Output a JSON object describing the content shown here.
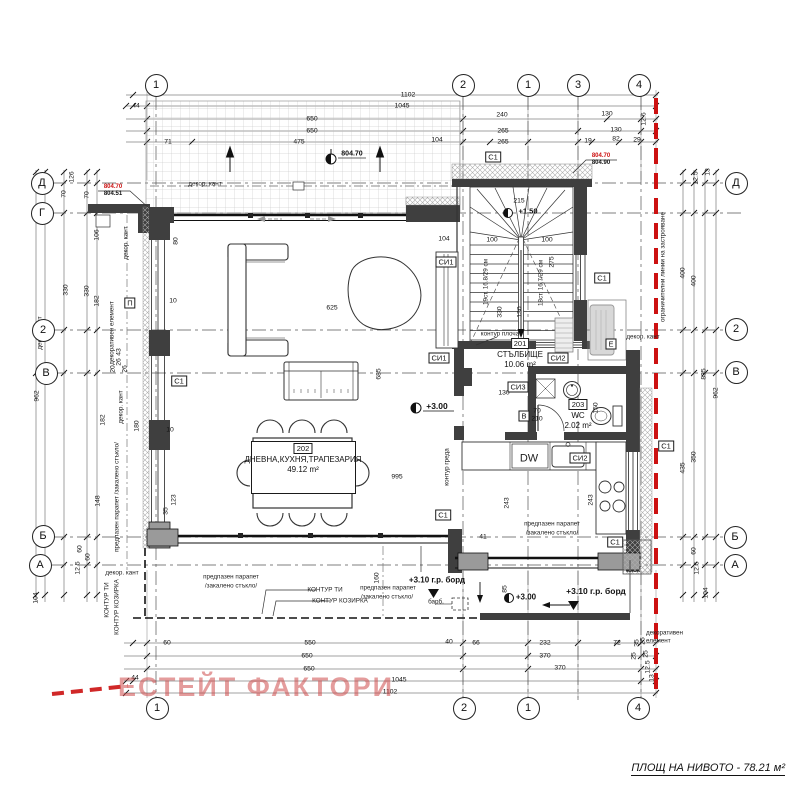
{
  "meta": {
    "watermark": "ЕСТЕЙТ ФАКТОРИ",
    "area_note": "ПЛОЩ НА НИВОТО - 78.21 м²"
  },
  "colors": {
    "regulation_line_red": "#cc1111",
    "wall_dark": "#3f3f3f",
    "pier_gray": "#9a9a9a",
    "watermark_red": "rgba(205,75,75,0.55)"
  },
  "grid_bubbles": [
    {
      "label": "1",
      "x": 156,
      "y": 85
    },
    {
      "label": "2",
      "x": 463,
      "y": 85
    },
    {
      "label": "1",
      "x": 528,
      "y": 85,
      "diamond": true
    },
    {
      "label": "3",
      "x": 578,
      "y": 85
    },
    {
      "label": "4",
      "x": 639,
      "y": 85
    },
    {
      "label": "1",
      "x": 157,
      "y": 708
    },
    {
      "label": "2",
      "x": 464,
      "y": 708
    },
    {
      "label": "1",
      "x": 528,
      "y": 708,
      "diamond": true
    },
    {
      "label": "4",
      "x": 638,
      "y": 708
    },
    {
      "label": "Д",
      "x": 42,
      "y": 183
    },
    {
      "label": "Г",
      "x": 42,
      "y": 213
    },
    {
      "label": "2",
      "x": 43,
      "y": 330,
      "diamond": true
    },
    {
      "label": "В",
      "x": 46,
      "y": 373
    },
    {
      "label": "Б",
      "x": 43,
      "y": 536
    },
    {
      "label": "А",
      "x": 40,
      "y": 565
    },
    {
      "label": "Д",
      "x": 736,
      "y": 183
    },
    {
      "label": "2",
      "x": 736,
      "y": 329,
      "diamond": true
    },
    {
      "label": "В",
      "x": 736,
      "y": 372
    },
    {
      "label": "Б",
      "x": 735,
      "y": 537
    },
    {
      "label": "А",
      "x": 735,
      "y": 565
    }
  ],
  "rooms": [
    {
      "number": "202",
      "name": "ДНЕВНА,КУХНЯ,ТРАПЕЗАРИЯ",
      "area": "49.12 m²",
      "cx": 303,
      "top": 443,
      "boxed": true,
      "bx": 251,
      "by": 441,
      "bw": 103,
      "bh": 51
    },
    {
      "number": "201",
      "name": "СТЪЛБИЩЕ",
      "area": "10.06 m²",
      "cx": 520,
      "top": 338
    },
    {
      "number": "203",
      "name": "WC",
      "area": "2.02 m²",
      "cx": 578,
      "top": 399
    }
  ],
  "tags": [
    {
      "t": "C1",
      "x": 493,
      "y": 157
    },
    {
      "t": "C1",
      "x": 602,
      "y": 278
    },
    {
      "t": "C1",
      "x": 179,
      "y": 381
    },
    {
      "t": "C1",
      "x": 443,
      "y": 515
    },
    {
      "t": "C1",
      "x": 615,
      "y": 542
    },
    {
      "t": "C1",
      "x": 666,
      "y": 446
    },
    {
      "t": "СИ1",
      "x": 446,
      "y": 262
    },
    {
      "t": "СИ1",
      "x": 439,
      "y": 358
    },
    {
      "t": "СИ2",
      "x": 558,
      "y": 358
    },
    {
      "t": "СИ2",
      "x": 580,
      "y": 458
    },
    {
      "t": "СИ3",
      "x": 518,
      "y": 387
    },
    {
      "t": "П",
      "x": 130,
      "y": 303
    },
    {
      "t": "B",
      "x": 524,
      "y": 416
    },
    {
      "t": "Е",
      "x": 611,
      "y": 344
    }
  ],
  "levels": [
    {
      "t": "804.70",
      "x": 113,
      "y": 187,
      "red": true,
      "fs": 6
    },
    {
      "t": "804.51",
      "x": 113,
      "y": 194,
      "fs": 6
    },
    {
      "t": "804.70",
      "x": 601,
      "y": 156,
      "red": true,
      "fs": 6
    },
    {
      "t": "804.90",
      "x": 601,
      "y": 163,
      "fs": 6
    },
    {
      "t": "804.70",
      "x": 352,
      "y": 154,
      "fs": 7
    },
    {
      "t": "+1.50",
      "x": 528,
      "y": 211,
      "fs": 7.5
    },
    {
      "t": "+3.00",
      "x": 437,
      "y": 406,
      "fs": 8.5
    },
    {
      "t": "+3.00",
      "x": 526,
      "y": 597,
      "fs": 8
    },
    {
      "t": "+3.10 г.р. борд",
      "x": 437,
      "y": 580,
      "fs": 8
    },
    {
      "t": "+3.10 г.р. борд",
      "x": 596,
      "y": 591,
      "fs": 8.5
    }
  ],
  "dims": [
    {
      "t": "1102",
      "x": 408,
      "y": 95
    },
    {
      "t": "44",
      "x": 136,
      "y": 106
    },
    {
      "t": "1045",
      "x": 402,
      "y": 106
    },
    {
      "t": "650",
      "x": 312,
      "y": 119
    },
    {
      "t": "240",
      "x": 502,
      "y": 115
    },
    {
      "t": "130",
      "x": 607,
      "y": 114
    },
    {
      "t": "12.6",
      "x": 644,
      "y": 119,
      "r": 1
    },
    {
      "t": "650",
      "x": 312,
      "y": 131
    },
    {
      "t": "265",
      "x": 503,
      "y": 131
    },
    {
      "t": "130",
      "x": 616,
      "y": 130
    },
    {
      "t": "71",
      "x": 168,
      "y": 142
    },
    {
      "t": "475",
      "x": 299,
      "y": 142
    },
    {
      "t": "104",
      "x": 437,
      "y": 140
    },
    {
      "t": "265",
      "x": 503,
      "y": 142
    },
    {
      "t": "19",
      "x": 588,
      "y": 141
    },
    {
      "t": "82",
      "x": 616,
      "y": 139
    },
    {
      "t": "29",
      "x": 637,
      "y": 140
    },
    {
      "t": "60",
      "x": 167,
      "y": 643
    },
    {
      "t": "550",
      "x": 310,
      "y": 643
    },
    {
      "t": "40",
      "x": 449,
      "y": 642
    },
    {
      "t": "66",
      "x": 476,
      "y": 643
    },
    {
      "t": "232",
      "x": 545,
      "y": 643
    },
    {
      "t": "72",
      "x": 617,
      "y": 643
    },
    {
      "t": "25",
      "x": 643,
      "y": 641,
      "r": 1
    },
    {
      "t": "650",
      "x": 307,
      "y": 656
    },
    {
      "t": "370",
      "x": 545,
      "y": 656
    },
    {
      "t": "25",
      "x": 646,
      "y": 654,
      "r": 1
    },
    {
      "t": "650",
      "x": 309,
      "y": 669
    },
    {
      "t": "370",
      "x": 560,
      "y": 668
    },
    {
      "t": "12.5",
      "x": 648,
      "y": 667,
      "r": 1
    },
    {
      "t": "1045",
      "x": 399,
      "y": 680
    },
    {
      "t": "13",
      "x": 652,
      "y": 678,
      "r": 1
    },
    {
      "t": "1102",
      "x": 390,
      "y": 692
    },
    {
      "t": "44",
      "x": 135,
      "y": 678
    },
    {
      "t": "962",
      "x": 37,
      "y": 396,
      "r": 1
    },
    {
      "t": "835",
      "x": 45,
      "y": 374,
      "r": 1
    },
    {
      "t": "126",
      "x": 72,
      "y": 177,
      "r": 1
    },
    {
      "t": "70",
      "x": 64,
      "y": 194,
      "r": 1
    },
    {
      "t": "70",
      "x": 87,
      "y": 195,
      "r": 1
    },
    {
      "t": "106",
      "x": 97,
      "y": 235,
      "r": 1
    },
    {
      "t": "330",
      "x": 66,
      "y": 290,
      "r": 1
    },
    {
      "t": "330",
      "x": 87,
      "y": 291,
      "r": 1
    },
    {
      "t": "182",
      "x": 97,
      "y": 301,
      "r": 1
    },
    {
      "t": "148",
      "x": 98,
      "y": 501,
      "r": 1
    },
    {
      "t": "60",
      "x": 80,
      "y": 549,
      "r": 1
    },
    {
      "t": "60",
      "x": 88,
      "y": 557,
      "r": 1
    },
    {
      "t": "12.5",
      "x": 78,
      "y": 568,
      "r": 1
    },
    {
      "t": "104",
      "x": 36,
      "y": 598,
      "r": 1
    },
    {
      "t": "12.5",
      "x": 696,
      "y": 178,
      "r": 1
    },
    {
      "t": "13",
      "x": 708,
      "y": 172,
      "r": 1
    },
    {
      "t": "400",
      "x": 683,
      "y": 273,
      "r": 1
    },
    {
      "t": "400",
      "x": 694,
      "y": 281,
      "r": 1
    },
    {
      "t": "835",
      "x": 704,
      "y": 374,
      "r": 1
    },
    {
      "t": "962",
      "x": 716,
      "y": 393,
      "r": 1
    },
    {
      "t": "350",
      "x": 694,
      "y": 457,
      "r": 1
    },
    {
      "t": "435",
      "x": 683,
      "y": 468,
      "r": 1
    },
    {
      "t": "60",
      "x": 694,
      "y": 551,
      "r": 1
    },
    {
      "t": "12.5",
      "x": 697,
      "y": 568,
      "r": 1
    },
    {
      "t": "104",
      "x": 706,
      "y": 593,
      "r": 1
    },
    {
      "t": "35",
      "x": 637,
      "y": 643,
      "r": 1
    },
    {
      "t": "25",
      "x": 634,
      "y": 656,
      "r": 1
    },
    {
      "t": "80",
      "x": 176,
      "y": 241,
      "r": 1
    },
    {
      "t": "104",
      "x": 444,
      "y": 239
    },
    {
      "t": "625",
      "x": 332,
      "y": 308
    },
    {
      "t": "995",
      "x": 397,
      "y": 477
    },
    {
      "t": "685",
      "x": 379,
      "y": 374,
      "r": 1
    },
    {
      "t": "215",
      "x": 519,
      "y": 201
    },
    {
      "t": "100",
      "x": 492,
      "y": 240
    },
    {
      "t": "100",
      "x": 547,
      "y": 240
    },
    {
      "t": "330",
      "x": 500,
      "y": 312,
      "r": 1
    },
    {
      "t": "275",
      "x": 552,
      "y": 262,
      "r": 1
    },
    {
      "t": "130",
      "x": 520,
      "y": 312,
      "r": 1
    },
    {
      "t": "123",
      "x": 174,
      "y": 500,
      "r": 1
    },
    {
      "t": "35",
      "x": 166,
      "y": 511,
      "r": 1
    },
    {
      "t": "243",
      "x": 507,
      "y": 503,
      "r": 1
    },
    {
      "t": "243",
      "x": 591,
      "y": 500,
      "r": 1
    },
    {
      "t": "41",
      "x": 483,
      "y": 537
    },
    {
      "t": "130",
      "x": 504,
      "y": 393
    },
    {
      "t": "150",
      "x": 596,
      "y": 408,
      "r": 1
    },
    {
      "t": "160",
      "x": 377,
      "y": 578,
      "r": 1
    },
    {
      "t": "85",
      "x": 505,
      "y": 589,
      "r": 1
    },
    {
      "t": "182",
      "x": 103,
      "y": 420,
      "r": 1
    },
    {
      "t": "180",
      "x": 137,
      "y": 426,
      "r": 1
    },
    {
      "t": "10",
      "x": 170,
      "y": 430
    },
    {
      "t": "10",
      "x": 173,
      "y": 301
    },
    {
      "t": "43",
      "x": 119,
      "y": 352,
      "r": 1
    },
    {
      "t": "26",
      "x": 119,
      "y": 362,
      "r": 1
    },
    {
      "t": "20",
      "x": 113,
      "y": 369,
      "r": 1
    },
    {
      "t": "26",
      "x": 125,
      "y": 369,
      "r": 1
    },
    {
      "t": "70",
      "x": 537,
      "y": 411
    },
    {
      "t": "210",
      "x": 537,
      "y": 419
    }
  ],
  "notes": [
    {
      "t": "декор. кант",
      "x": 205,
      "y": 184
    },
    {
      "t": "декор. кант",
      "x": 126,
      "y": 243,
      "r": 1
    },
    {
      "t": "декор. кант",
      "x": 40,
      "y": 333,
      "r": 1
    },
    {
      "t": "декор. кант",
      "x": 121,
      "y": 407,
      "r": 1
    },
    {
      "t": "декор. кант",
      "x": 643,
      "y": 337
    },
    {
      "t": "декор. кант",
      "x": 122,
      "y": 573
    },
    {
      "t": "декоративен елемент",
      "x": 112,
      "y": 333,
      "r": 1
    },
    {
      "t": "декоративен елемент",
      "x": 670,
      "y": 637,
      "w": 48
    },
    {
      "t": "предпазен парапет",
      "x": 231,
      "y": 577
    },
    {
      "t": "/закалено стъкло/",
      "x": 231,
      "y": 586
    },
    {
      "t": "предпазен парапет",
      "x": 388,
      "y": 588
    },
    {
      "t": "/закалено стъкло/",
      "x": 387,
      "y": 597
    },
    {
      "t": "предпазен парапет",
      "x": 552,
      "y": 524
    },
    {
      "t": "/закалено стъкло/",
      "x": 552,
      "y": 533
    },
    {
      "t": "предпазен парапет /закалено стъкло/",
      "x": 117,
      "y": 497,
      "r": 1
    },
    {
      "t": "КОНТУР ТИ",
      "x": 325,
      "y": 590
    },
    {
      "t": "КОНТУР КОЗИРКА",
      "x": 340,
      "y": 601
    },
    {
      "t": "КОНТУР ТИ",
      "x": 107,
      "y": 600,
      "r": 1
    },
    {
      "t": "КОНТУР КОЗИРКА",
      "x": 117,
      "y": 607,
      "r": 1
    },
    {
      "t": "контур греда",
      "x": 447,
      "y": 467,
      "r": 1
    },
    {
      "t": "контур плоча",
      "x": 500,
      "y": 334
    },
    {
      "t": "ограничителни линии на застрояване",
      "x": 663,
      "y": 267,
      "r": 1
    },
    {
      "t": "барб.",
      "x": 436,
      "y": 602
    },
    {
      "t": "DW",
      "x": 529,
      "y": 459,
      "fs": 11
    },
    {
      "t": "19ст. 16.8/29 см",
      "x": 486,
      "y": 282,
      "r": 1
    },
    {
      "t": "18ст. 16.7/29 см",
      "x": 541,
      "y": 283,
      "r": 1
    }
  ]
}
